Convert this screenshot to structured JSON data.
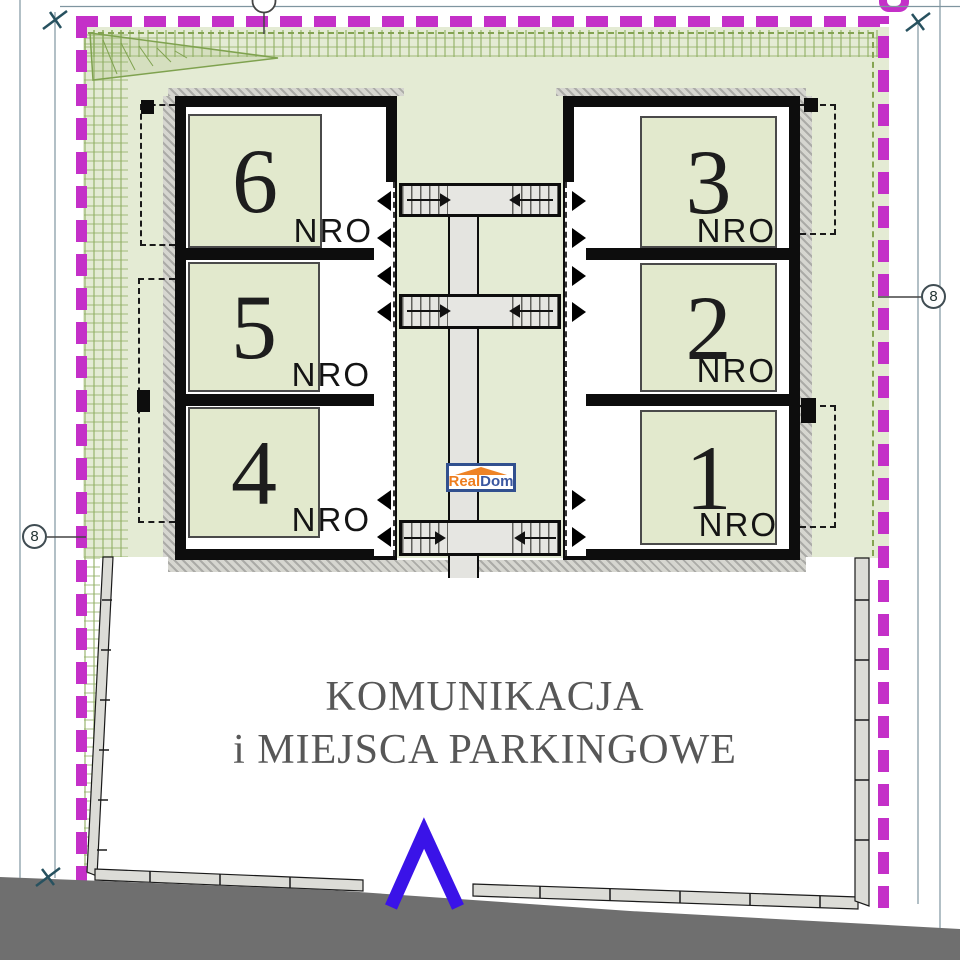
{
  "rooms": [
    {
      "number": "6",
      "tag": "NRO"
    },
    {
      "number": "5",
      "tag": "NRO"
    },
    {
      "number": "4",
      "tag": "NRO"
    },
    {
      "number": "3",
      "tag": "NRO"
    },
    {
      "number": "2",
      "tag": "NRO"
    },
    {
      "number": "1",
      "tag": "NRO"
    }
  ],
  "parking": {
    "line1": "KOMUNIKACJA",
    "line2": "i MIEJSCA PARKINGOWE"
  },
  "watermark": {
    "part1": "Real",
    "part2": "Dom"
  },
  "markers": {
    "left": "8",
    "right": "8"
  },
  "colors": {
    "boundary_magenta": "#c430c8",
    "plot_green": "#e4ebd4",
    "room_green": "#e2e9cd",
    "hatch_green": "#8fae62",
    "wall_black": "#0d0d0d",
    "corridor_gray": "#e4e4e0",
    "bottom_band_gray": "#6f6f6f",
    "chevron_blue": "#3a13e8",
    "logo_orange": "#ee7d1e",
    "logo_blue": "#3a57a0",
    "parking_text_gray": "#575757"
  }
}
